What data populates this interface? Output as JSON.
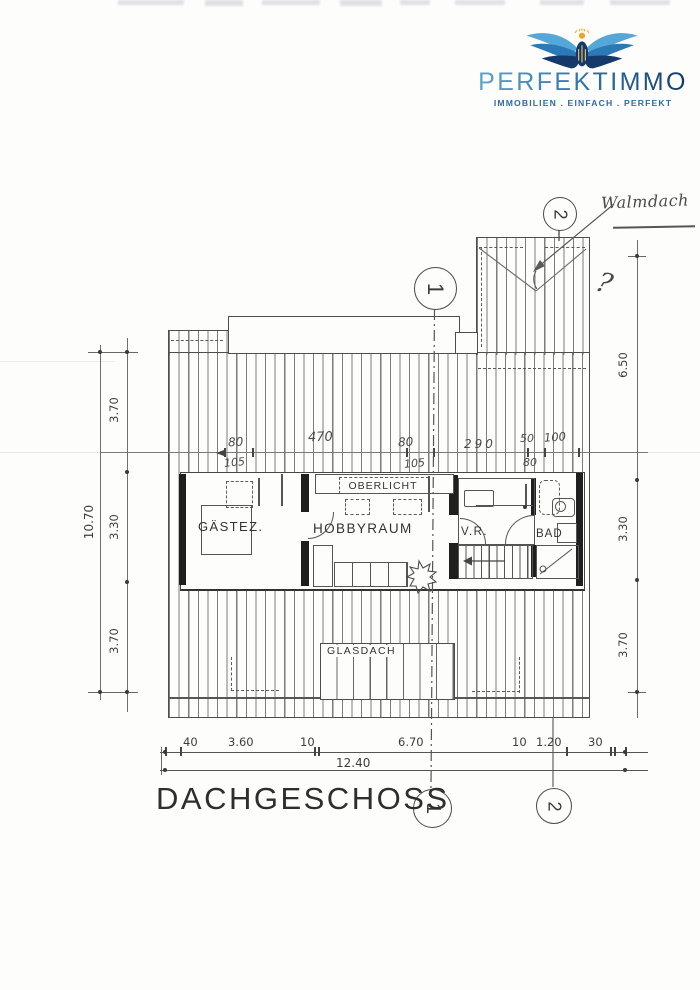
{
  "scan": {
    "ink": "#4a4a4a",
    "wall_fill": "#1f1f1f",
    "paper": "#fdfdfc"
  },
  "logo": {
    "brand": "PERFEKTIMMO",
    "tagline": "IMMOBILIEN . EINFACH . PERFEKT",
    "colors": {
      "wing_light": "#54a7d6",
      "wing_mid": "#2b7ab8",
      "wing_dark": "#16396b",
      "gold": "#efa524",
      "text_start": "#5ba4d0",
      "text_end": "#123a68",
      "tagline": "#2e6ba6"
    }
  },
  "plan": {
    "title": "DACHGESCHOSS",
    "rooms": {
      "guest": "GÄSTEZ.",
      "hobby": "HOBBYRAUM",
      "skylight": "OBERLICHT",
      "hall": "V.R.",
      "bath": "BAD",
      "glass_roof": "GLASDACH"
    },
    "markers": {
      "one": "1",
      "two": "2"
    },
    "handwriting": {
      "note": "Walmdach",
      "question": "?"
    },
    "dims": {
      "top": {
        "segments": [
          "80",
          "470",
          "80",
          "290",
          "50",
          "100"
        ],
        "subs": [
          "105",
          "105",
          "80"
        ]
      },
      "left": {
        "total": "10.70",
        "segments": [
          "3.70",
          "3.30",
          "3.70"
        ]
      },
      "right": {
        "segments": [
          "6.50",
          "3.30",
          "3.70"
        ]
      },
      "bottom": {
        "segments": [
          "40",
          "3.60",
          "10",
          "6.70",
          "10",
          "1.20",
          "30"
        ],
        "total": "12.40"
      }
    }
  }
}
